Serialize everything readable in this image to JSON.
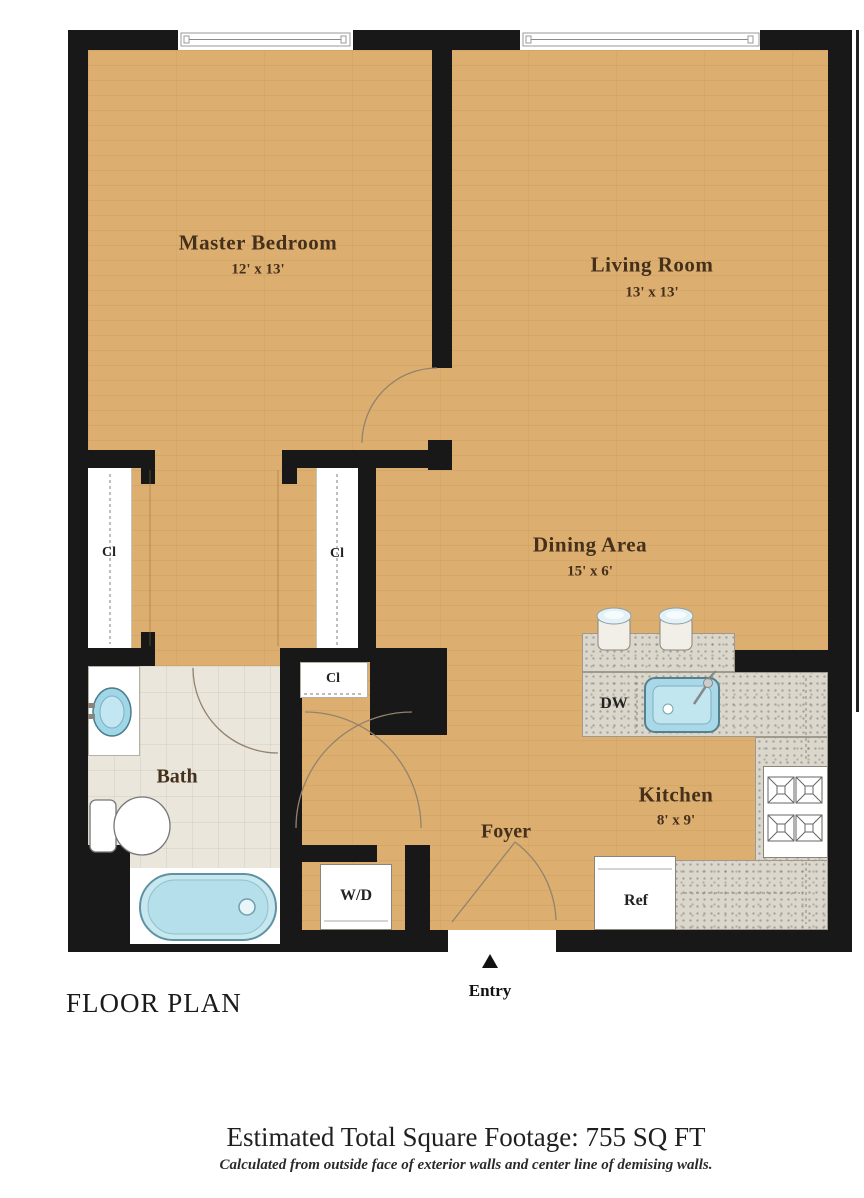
{
  "floor_plan": {
    "title": "FLOOR PLAN",
    "entry": "Entry",
    "rooms": {
      "master_bedroom": {
        "name": "Master Bedroom",
        "dims": "12' x 13'"
      },
      "living_room": {
        "name": "Living Room",
        "dims": "13' x 13'"
      },
      "dining_area": {
        "name": "Dining Area",
        "dims": "15' x 6'"
      },
      "kitchen": {
        "name": "Kitchen",
        "dims": "8' x 9'"
      },
      "bath": {
        "name": "Bath"
      },
      "foyer": {
        "name": "Foyer"
      }
    },
    "fixtures": {
      "closet_left": "Cl",
      "closet_middle": "Cl",
      "closet_foyer": "Cl",
      "washer_dryer": "W/D",
      "dishwasher": "DW",
      "refrigerator": "Ref"
    }
  },
  "footer": {
    "title": "Estimated Total Square Footage: 755 SQ FT",
    "subtitle": "Calculated from outside face of exterior walls and center line of demising walls."
  },
  "colors": {
    "wall": "#181818",
    "wood_floor": "#dcae70",
    "bath_tile": "#eae6db",
    "counter": "#dbd7cc",
    "fixture_blue": "#b8e0ed",
    "label_brown": "#45301b"
  }
}
